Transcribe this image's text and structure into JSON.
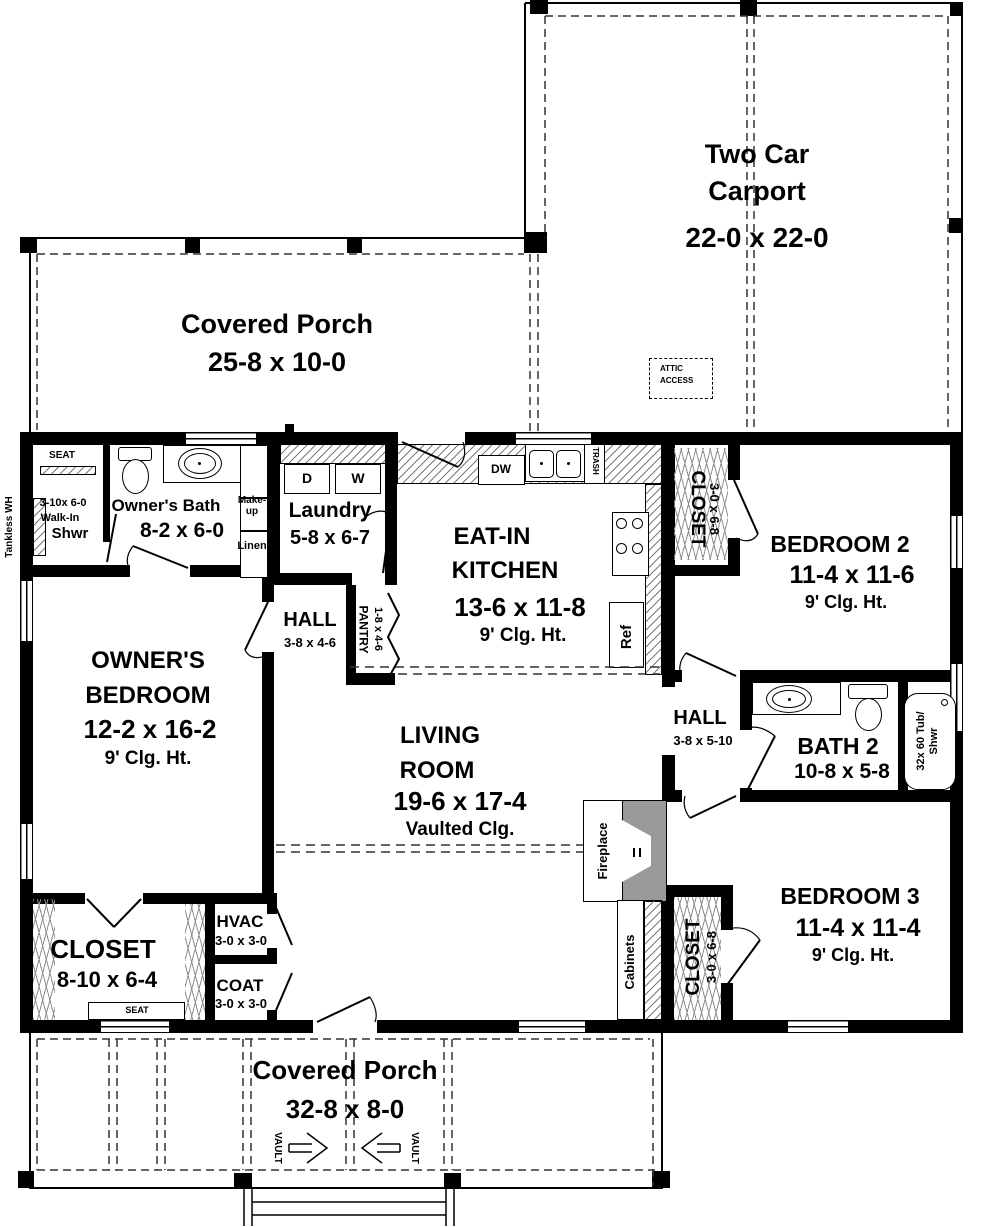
{
  "rooms": {
    "carport": {
      "name1": "Two Car",
      "name2": "Carport",
      "dims": "22-0 x 22-0"
    },
    "attic": {
      "line1": "ATTIC",
      "line2": "ACCESS"
    },
    "porch_top": {
      "name": "Covered Porch",
      "dims": "25-8 x 10-0"
    },
    "porch_bottom": {
      "name": "Covered Porch",
      "dims": "32-8 x 8-0",
      "vault": "VAULT"
    },
    "owners_bath": {
      "name": "Owner's Bath",
      "dims": "8-2 x 6-0",
      "seat": "SEAT",
      "shwr1": "3-10x 6-0",
      "shwr2": "Walk-In",
      "shwr3": "Shwr",
      "makeup1": "Make-",
      "makeup2": "up",
      "linen": "Linen"
    },
    "tankless": {
      "label": "Tankless WH"
    },
    "laundry": {
      "name": "Laundry",
      "dims": "5-8 x 6-7",
      "dryer": "D",
      "washer": "W"
    },
    "kitchen": {
      "name1": "EAT-IN",
      "name2": "KITCHEN",
      "dims": "13-6 x 11-8",
      "clg": "9' Clg. Ht.",
      "dw": "DW",
      "trash": "TRASH",
      "ref": "Ref"
    },
    "hall1": {
      "name": "HALL",
      "dims": "3-8 x 4-6"
    },
    "pantry": {
      "name": "PANTRY",
      "dims": "1-8 x 4-6"
    },
    "closet_bed2": {
      "name": "CLOSET",
      "dims": "3-0 x 6-8"
    },
    "bedroom2": {
      "name": "BEDROOM 2",
      "dims": "11-4 x 11-6",
      "clg": "9' Clg. Ht."
    },
    "owners_bedroom": {
      "name1": "OWNER'S",
      "name2": "BEDROOM",
      "dims": "12-2 x 16-2",
      "clg": "9' Clg. Ht."
    },
    "living": {
      "name1": "LIVING",
      "name2": "ROOM",
      "dims": "19-6 x 17-4",
      "clg": "Vaulted Clg."
    },
    "hall2": {
      "name": "HALL",
      "dims": "3-8 x 5-10"
    },
    "bath2": {
      "name": "BATH 2",
      "dims": "10-8 x 5-8",
      "tub1": "32x 60 Tub/",
      "tub2": "Shwr"
    },
    "fireplace": {
      "label": "Fireplace"
    },
    "cabinets": {
      "label": "Cabinets"
    },
    "closet_owners": {
      "name": "CLOSET",
      "dims": "8-10 x 6-4",
      "seat": "SEAT"
    },
    "hvac": {
      "name": "HVAC",
      "dims": "3-0 x 3-0"
    },
    "coat": {
      "name": "COAT",
      "dims": "3-0 x 3-0"
    },
    "closet_bed3": {
      "name": "CLOSET",
      "dims": "3-0 x 6-8"
    },
    "bedroom3": {
      "name": "BEDROOM 3",
      "dims": "11-4 x 11-4",
      "clg": "9' Clg. Ht."
    }
  },
  "colors": {
    "wall": "#000000",
    "fireplace": "#9a9a9a",
    "dash": "#333333"
  }
}
